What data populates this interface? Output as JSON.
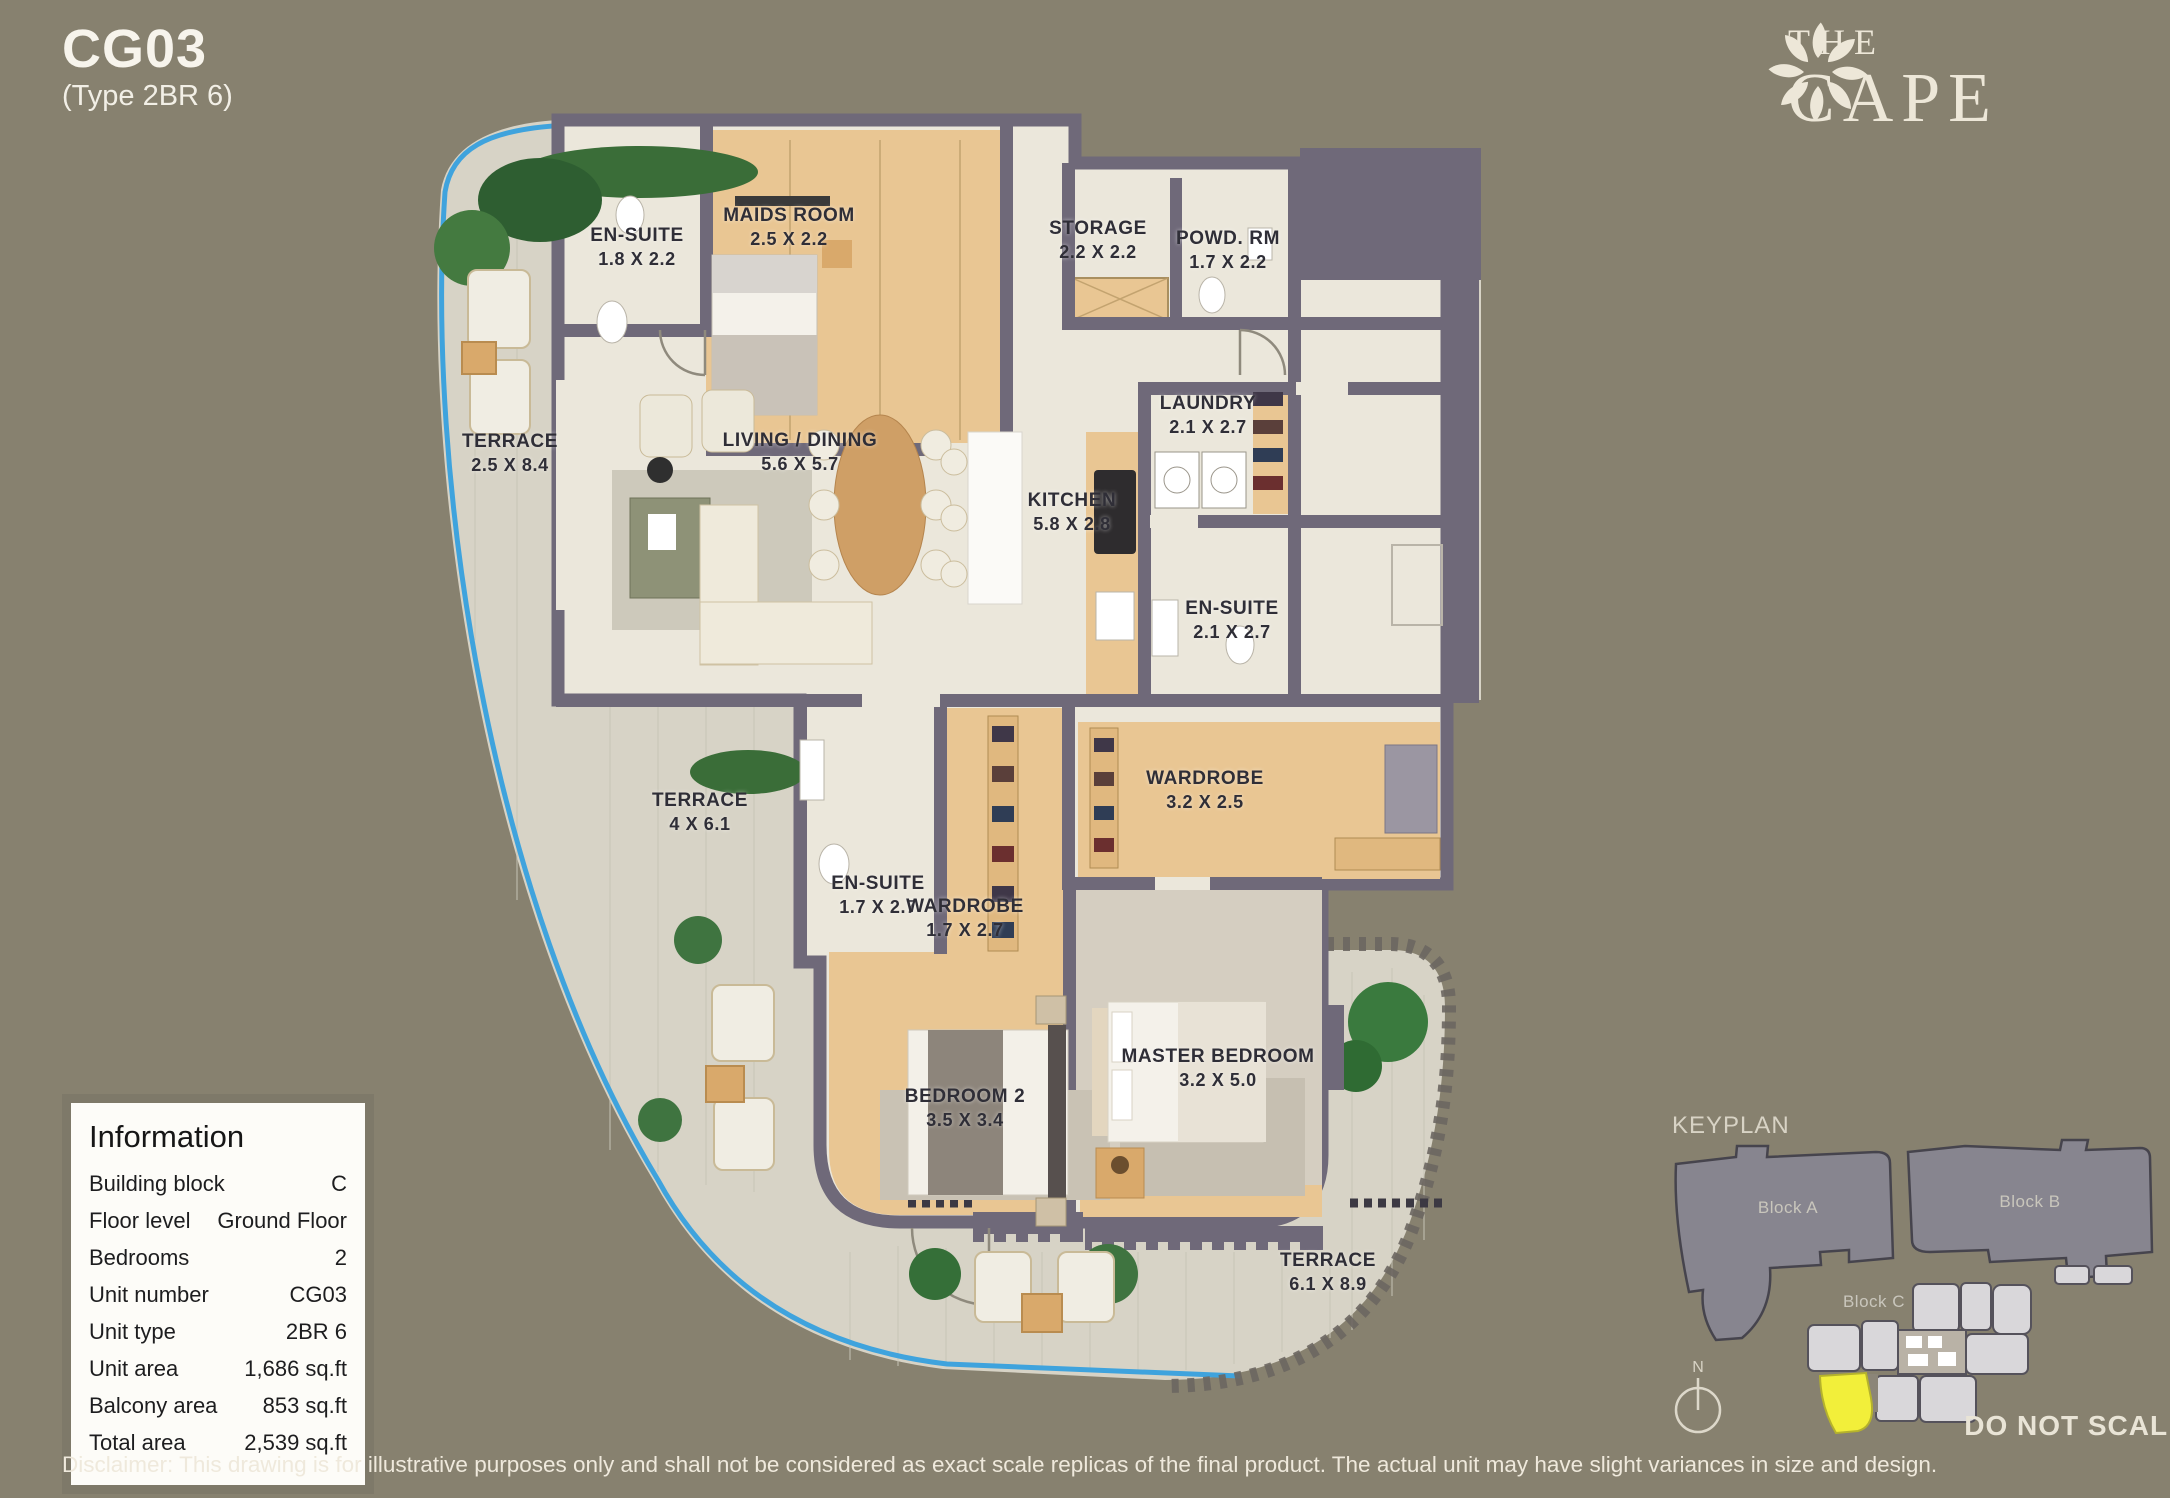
{
  "page": {
    "unit_code": "CG03",
    "unit_type_label": "(Type 2BR 6)"
  },
  "brand": {
    "name_top": "THE",
    "name_bottom": "CAPE",
    "logo": "flower-icon"
  },
  "floorplan": {
    "rooms": [
      {
        "name": "EN-SUITE",
        "dims": "1.8 X 2.2"
      },
      {
        "name": "MAIDS ROOM",
        "dims": "2.5 X 2.2"
      },
      {
        "name": "STORAGE",
        "dims": "2.2 X 2.2"
      },
      {
        "name": "POWD. RM",
        "dims": "1.7 X 2.2"
      },
      {
        "name": "TERRACE",
        "dims": "2.5 X 8.4"
      },
      {
        "name": "LIVING / DINING",
        "dims": "5.6 X 5.7"
      },
      {
        "name": "KITCHEN",
        "dims": "5.8 X 2.8"
      },
      {
        "name": "LAUNDRY",
        "dims": "2.1 X 2.7"
      },
      {
        "name": "EN-SUITE",
        "dims": "2.1 X 2.7"
      },
      {
        "name": "TERRACE",
        "dims": "4 X 6.1"
      },
      {
        "name": "EN-SUITE",
        "dims": "1.7 X 2.7"
      },
      {
        "name": "WARDROBE",
        "dims": "1.7 X 2.7"
      },
      {
        "name": "WARDROBE",
        "dims": "3.2 X 2.5"
      },
      {
        "name": "BEDROOM 2",
        "dims": "3.5 X 3.4"
      },
      {
        "name": "MASTER BEDROOM",
        "dims": "3.2 X 5.0"
      },
      {
        "name": "TERRACE",
        "dims": "6.1 X 8.9"
      }
    ]
  },
  "information": {
    "title": "Information",
    "rows": [
      {
        "label": "Building block",
        "value": "C"
      },
      {
        "label": "Floor level",
        "value": "Ground Floor"
      },
      {
        "label": "Bedrooms",
        "value": "2"
      },
      {
        "label": "Unit number",
        "value": "CG03"
      },
      {
        "label": "Unit type",
        "value": "2BR 6"
      },
      {
        "label": "Unit area",
        "value": "1,686 sq.ft"
      },
      {
        "label": "Balcony area",
        "value": "853 sq.ft"
      },
      {
        "label": "Total area",
        "value": "2,539 sq.ft"
      }
    ]
  },
  "keyplan": {
    "title": "KEYPLAN",
    "block_a": "Block A",
    "block_b": "Block B",
    "block_c": "Block C",
    "compass": "N",
    "note": "DO NOT SCALE"
  },
  "disclaimer": "Disclaimer: This drawing is for illustrative purposes only and shall not be considered as exact scale replicas of the final product. The actual unit may have slight variances in size and design.",
  "colors": {
    "background": "#87816F",
    "wall": "#6F6979",
    "terrace_tile": "#D7D3C6",
    "interior_floor": "#EBE7DB",
    "wood_floor": "#E9C693",
    "pool_line": "#3FA3DD",
    "highlight_unit": "#F2EF3A",
    "keyplan_block": "#87858F"
  }
}
